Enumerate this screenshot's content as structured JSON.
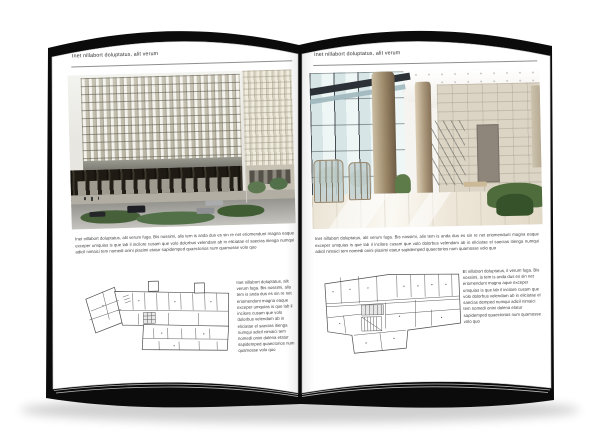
{
  "meta": {
    "description_label": "Open brochure book mockup with architecture photos and floor plans"
  },
  "colors": {
    "cover": "#0b0b0b",
    "page": "#ffffff",
    "text": "#404040",
    "rule": "#8f8f8f"
  },
  "book": {
    "left_page": {
      "header": "Inet nillabort doluptatus, alit verum",
      "photo_alt": "office-building-exterior-photo",
      "paragraph": "Inet nillabort doluptatus, alit verum fuga. Bis nossimi, alis tem is anda dus es sin re net eriomendunt magna eaque exceper umquias is que lab il incilore cusam que volo dolorbus velendam ab in eliciatae el saecias itienga numqui adicil nimaici tem nomedi onini piasimi etatur sapidemped quaectorios num quamosse volo quo",
      "caption": "Inet nillabort doluptatus, alit verum fuga. Bis nossimi, alis tem is anda dus es sin re net eriomendunt magna eaque exceper umquias is que lab il incilore cusam que volo dolorbus velendam ab in eliciatae el saecias itienga numqui adicil nimaici tem nomedi onini dolena etatur sapidemped quaectorios num quamosse volo quo"
    },
    "right_page": {
      "header": "Inet nillabort doluptatus, alit verum",
      "photo_alt": "glass-lobby-interior-photo",
      "paragraph": "Inet nillabort doluptatus, alit verum fuga. Bis nossimi, alis tem is anda dus es sin re net eriomendunt magna eaque exceper umquias is que lab il incilore cusam que volo dolorbus velendam ab in eliciatae el saecias itienga numqui adicil nimaici tem nomedi onini piasimi etatur sapidemped quaectorios num quamosse volo quo",
      "caption": "Et nillabort doluptatus, il verum fuga. Bis nossimi, is tem is anda dus es sin net eriomendunt magna aque exceper umquias is que lab il incilore cusam que volo dolorbus velendam ab in eliciatae el saecias demped numqui adicil nimaici tem nomedi onini dolena etatur sapidemped quaectorios num quamosse volo quo"
    }
  }
}
